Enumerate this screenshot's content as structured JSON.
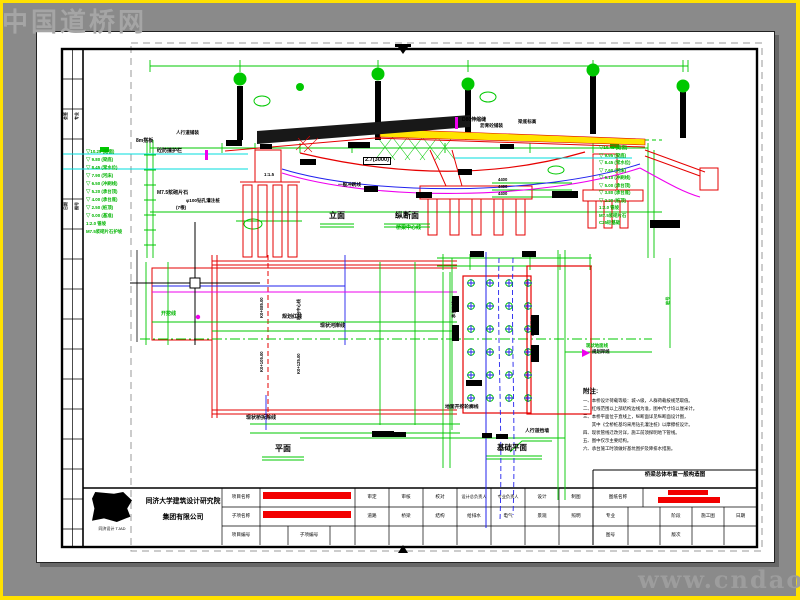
{
  "watermarks": {
    "top_left": "中国道桥网",
    "bottom_right": "www.cndao.com"
  },
  "view_titles": {
    "elevation": "立面",
    "profile": "纵断面",
    "plan": "平面",
    "foundation_plan": "基础平面"
  },
  "notes": {
    "title": "附注:",
    "lines": [
      "一、本桥设计荷载等级：城-A级，人群荷载按规范取值。",
      "二、红线范围以上部结构边线为准，图中尺寸均以厘米计。",
      "三、本桥平面位于直线上，纵断面详见纵断面设计图，",
      "　　其中《全桥桩基均采用钻孔灌注桩》以摩擦桩设计。",
      "四、现状管线迁改另详，施工前须探明地下管线。",
      "五、图中仅示主要结构。",
      "六、承台施工时须做好基坑围护及降排水措施。"
    ]
  },
  "green_table_left": [
    "▽10.25 (路面)",
    "▽ 9.80 (梁底)",
    "▽ 8.45 (常水位)",
    "▽ 7.90 (河床)",
    "▽ 6.50 (冲刷线)",
    "▽ 5.20 (承台顶)",
    "▽ 4.00 (承台底)",
    "▽ 2.50 (桩顶)",
    "▽ 0.00 (基准)",
    "1:2.0 锥坡",
    "M7.5浆砌片石护坡"
  ],
  "green_table_right": [
    "▽10.45 (路面)",
    "▽ 9.95 (梁底)",
    "▽ 8.45 (常水位)",
    "▽ 7.60 (河床)",
    "▽ 6.10 (冲刷线)",
    "▽ 5.00 (承台顶)",
    "▽ 3.80 (承台底)",
    "▽ 2.20 (桩顶)",
    "1:2.0 锥坡",
    "M7.5浆砌片石",
    "C25砼基础"
  ],
  "labels": [
    {
      "t": "砼防撞护栏",
      "x": 157,
      "y": 149,
      "s": 5
    },
    {
      "t": "8m搭板",
      "x": 136,
      "y": 139,
      "s": 5
    },
    {
      "t": "人行道铺装",
      "x": 176,
      "y": 131,
      "s": 4.6
    },
    {
      "t": "M7.5浆砌片石",
      "x": 157,
      "y": 191,
      "s": 5
    },
    {
      "t": "φ100钻孔灌注桩",
      "x": 186,
      "y": 199,
      "s": 4.6
    },
    {
      "t": "(7根)",
      "x": 176,
      "y": 206,
      "s": 4.6
    },
    {
      "t": "1:1.5",
      "x": 264,
      "y": 173,
      "s": 4.4
    },
    {
      "t": "2.7(3000)",
      "x": 363,
      "y": 157,
      "s": 5.6,
      "b": 1
    },
    {
      "t": "一般冲刷线",
      "x": 338,
      "y": 183,
      "s": 4.6
    },
    {
      "t": "D80伸缩缝",
      "x": 462,
      "y": 118,
      "s": 5
    },
    {
      "t": "沥青砼铺装",
      "x": 480,
      "y": 124,
      "s": 4.6
    },
    {
      "t": "梁底标高",
      "x": 518,
      "y": 120,
      "s": 4.6
    },
    {
      "t": "4400",
      "x": 498,
      "y": 178,
      "s": 4.2
    },
    {
      "t": "4400",
      "x": 498,
      "y": 185,
      "s": 4.2
    },
    {
      "t": "4400",
      "x": 498,
      "y": 192,
      "s": 4.2
    },
    {
      "t": "桥梁中心线",
      "x": 396,
      "y": 226,
      "s": 5,
      "c": "#00b400"
    },
    {
      "t": "开挖线",
      "x": 161,
      "y": 312,
      "s": 5,
      "c": "#00b400"
    },
    {
      "t": "现状桥拆除线",
      "x": 246,
      "y": 416,
      "s": 5
    },
    {
      "t": "规划红线",
      "x": 282,
      "y": 315,
      "s": 5
    },
    {
      "t": "现状河岸线",
      "x": 320,
      "y": 324,
      "s": 5
    },
    {
      "t": "K0+085.00",
      "x": 260,
      "y": 318,
      "s": 4.2,
      "r": -90
    },
    {
      "t": "K0+105.00",
      "x": 260,
      "y": 372,
      "s": 4.2,
      "r": -90
    },
    {
      "t": "桥台中心线",
      "x": 297,
      "y": 320,
      "s": 4.2,
      "r": -90
    },
    {
      "t": "K0+125.00",
      "x": 297,
      "y": 374,
      "s": 4.2,
      "r": -90
    },
    {
      "t": "承台边线",
      "x": 452,
      "y": 318,
      "s": 4.2,
      "r": -90
    },
    {
      "t": "φ80钻孔桩",
      "x": 531,
      "y": 336,
      "s": 4.2,
      "r": -90
    },
    {
      "t": "地面开挖轮廓线",
      "x": 445,
      "y": 406,
      "s": 4.8
    },
    {
      "t": "人行道挡墙",
      "x": 525,
      "y": 430,
      "s": 4.8
    },
    {
      "t": "现状地面线",
      "x": 586,
      "y": 344,
      "s": 4.4,
      "c": "#00b400"
    },
    {
      "t": "规划岸线",
      "x": 592,
      "y": 350,
      "s": 4.4
    },
    {
      "t": "会签",
      "x": 64,
      "y": 120,
      "s": 4,
      "r": -90
    },
    {
      "t": "专业",
      "x": 75,
      "y": 120,
      "s": 4,
      "r": -90
    },
    {
      "t": "日期",
      "x": 64,
      "y": 210,
      "s": 4,
      "r": -90
    },
    {
      "t": "图号",
      "x": 75,
      "y": 210,
      "s": 4,
      "r": -90
    },
    {
      "t": "桩号",
      "x": 666,
      "y": 305,
      "s": 4.2,
      "r": -90,
      "c": "#00b400"
    }
  ],
  "titleblock": {
    "company_line1": "同济大学建筑设计研究院",
    "company_line2": "集团有限公司",
    "logo_caption": "同济设计 TJAD",
    "project_label": "项目名称",
    "subproject_label": "子项名称",
    "project_no_label": "项目编号",
    "subproject_no_label": "子项编号",
    "sign_row1": [
      "审定",
      "审核",
      "校对",
      "设计总负责人",
      "专业负责人",
      "设计",
      "制图"
    ],
    "sign_row2": [
      "道路",
      "桥梁",
      "结构",
      "给排水",
      "电气",
      "景观",
      "照明"
    ],
    "sheet_name_label": "图纸名称",
    "sheet_title": "桥梁总体布置一般构造图",
    "spec_label": "专业",
    "stage_label": "阶段",
    "stage_value": "施工图",
    "date_label": "日期",
    "sheet_no_label": "图号",
    "rev_label": "版次"
  },
  "colors": {
    "cad_red": "#e60000",
    "cad_green": "#00c800",
    "cad_blue": "#2222ee",
    "cad_cyan": "#00dcdc",
    "cad_magenta": "#ee00ee",
    "deck_yellow": "#ffe400",
    "paper": "#ffffff",
    "desktop": "#8a8a8a",
    "frame_yellow": "#ffe100",
    "redaction": "#f20000"
  }
}
